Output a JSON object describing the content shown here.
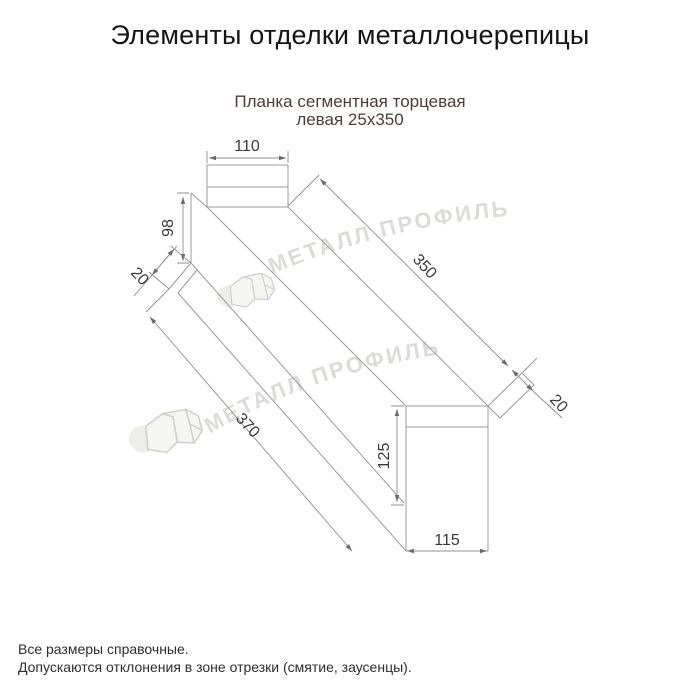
{
  "title": "Элементы отделки металлочерепицы",
  "subtitle": {
    "line1": "Планка сегментная торцевая",
    "line2": "левая 25x350"
  },
  "watermark": {
    "brand": "МЕТАЛЛ ПРОФИЛЬ",
    "logo": "house-roof-icon"
  },
  "drawing": {
    "dimensions": {
      "top_flange_width": "110",
      "left_end_height": "98",
      "left_hem": "20",
      "top_length": "350",
      "right_hem": "20",
      "bottom_length": "370",
      "end_face_height": "125",
      "end_face_width": "115"
    }
  },
  "footer": {
    "line1": "Все размеры справочные.",
    "line2": "Допускаются отклонения в зоне отрезки (смятие, заусенцы)."
  },
  "colors": {
    "background": "#ffffff",
    "outline": "#9b9b9b",
    "dimension_line": "#8f8f8f",
    "arrow": "#6a6a6a",
    "dimension_text": "#3a3a3a",
    "title_text": "#151515",
    "subtitle_text": "#4f3b3c",
    "watermark": "#d9d8d4"
  }
}
